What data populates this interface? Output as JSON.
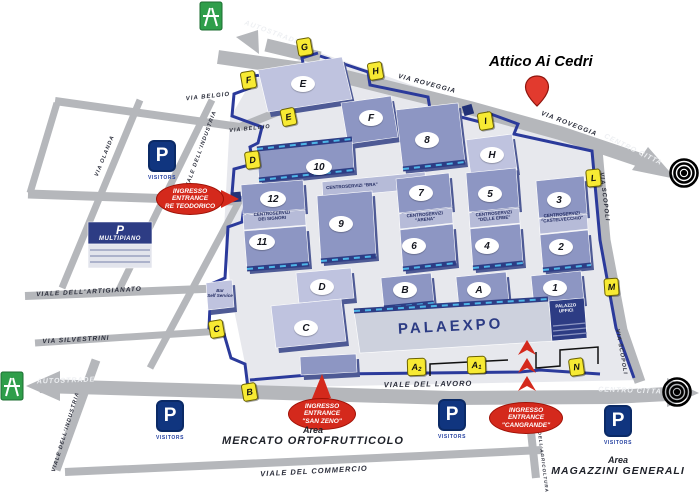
{
  "annotation": {
    "title": "Attico Ai Cedri"
  },
  "colors": {
    "road": "#b5b7bb",
    "boundary": "#2b3a9b",
    "hall": "#8d96c3",
    "hall_light": "#bfc3df",
    "service_strip": "#b6bbd8",
    "navy": "#2d3c84",
    "cyan_dash": "#4db5e8",
    "gate_yellow": "#f7ea33",
    "entrance_red": "#d4291c",
    "motorway_green": "#2f9e4a",
    "parking_navy": "#10357f",
    "ground": "#e7e8ed"
  },
  "roads": {
    "labels": [
      {
        "text": "AUTOSTRADE",
        "x": 272,
        "y": 33,
        "rot": 20,
        "tone": "light",
        "size": 7
      },
      {
        "text": "VIA  ROVEGGIA",
        "x": 427,
        "y": 84,
        "rot": 15,
        "tone": "dark",
        "size": 6.5
      },
      {
        "text": "VIA  ROVEGGIA",
        "x": 569,
        "y": 124,
        "rot": 21,
        "tone": "dark",
        "size": 6.5
      },
      {
        "text": "CENTRO CITTA",
        "x": 633,
        "y": 150,
        "rot": 26,
        "tone": "light",
        "size": 7
      },
      {
        "text": "VIA SCOPOLI",
        "x": 604,
        "y": 197,
        "rot": 83,
        "tone": "dark",
        "size": 6
      },
      {
        "text": "VIA SCOPOLI",
        "x": 621,
        "y": 352,
        "rot": 80,
        "tone": "dark",
        "size": 5.5
      },
      {
        "text": "VIA BELGIO",
        "x": 208,
        "y": 97,
        "rot": -6,
        "tone": "dark",
        "size": 6
      },
      {
        "text": "VIA BELGIO",
        "x": 250,
        "y": 129,
        "rot": -6,
        "tone": "dark",
        "size": 5.5
      },
      {
        "text": "VIA OLANDA",
        "x": 105,
        "y": 156,
        "rot": -68,
        "tone": "dark",
        "size": 5.5
      },
      {
        "text": "VIALE DELL'INDUSTRIA",
        "x": 201,
        "y": 150,
        "rot": -70,
        "tone": "dark",
        "size": 5.5
      },
      {
        "text": "VIALE DELL'ARTIGIANATO",
        "x": 89,
        "y": 292,
        "rot": -3,
        "tone": "dark",
        "size": 6.5
      },
      {
        "text": "VIA SILVESTRINI",
        "x": 76,
        "y": 340,
        "rot": -3,
        "tone": "dark",
        "size": 6.5
      },
      {
        "text": "AUTOSTRADE",
        "x": 66,
        "y": 381,
        "rot": -2,
        "tone": "light",
        "size": 7
      },
      {
        "text": "VIALE DELL'INDUSTRIA",
        "x": 66,
        "y": 432,
        "rot": -73,
        "tone": "dark",
        "size": 5.5
      },
      {
        "text": "VIALE  DEL  LAVORO",
        "x": 428,
        "y": 384,
        "rot": -1,
        "tone": "dark",
        "size": 7.5
      },
      {
        "text": "CENTRO CITTA",
        "x": 630,
        "y": 391,
        "rot": 2,
        "tone": "light",
        "size": 7
      },
      {
        "text": "VIALE DEL COMMERCIO",
        "x": 314,
        "y": 471,
        "rot": -3,
        "tone": "dark",
        "size": 7.5
      },
      {
        "text": "VIALE DELL'AGRICOLTURA",
        "x": 542,
        "y": 452,
        "rot": 83,
        "tone": "dark",
        "size": 4.5
      }
    ],
    "geometry": [
      {
        "id": "via-roveggia",
        "pts": "218,57 330,73 470,108 560,133 640,160",
        "w": 14
      },
      {
        "id": "autostrade-top",
        "pts": "320,58 266,45",
        "w": 13
      },
      {
        "id": "via-belgio",
        "pts": "55,101 240,127",
        "w": 8
      },
      {
        "id": "belgio-link",
        "pts": "240,127 310,99",
        "w": 8
      },
      {
        "id": "left-edge",
        "pts": "57,103 30,193",
        "w": 7
      },
      {
        "id": "via-olanda",
        "pts": "62,288 140,100",
        "w": 7
      },
      {
        "id": "viale-industria",
        "pts": "118,292 212,100",
        "w": 7
      },
      {
        "id": "diagonal-3",
        "pts": "150,368 242,196",
        "w": 7
      },
      {
        "id": "teodorico-road",
        "pts": "28,194 236,201",
        "w": 9
      },
      {
        "id": "viale-artigianato",
        "pts": "25,296 228,288",
        "w": 8
      },
      {
        "id": "via-silvestrini",
        "pts": "35,343 222,331",
        "w": 7
      },
      {
        "id": "lavoro-autostrade",
        "pts": "40,386 250,392 450,398 612,397 668,394",
        "w": 14
      },
      {
        "id": "via-scopoli",
        "pts": "597,150 605,240 622,330 640,382",
        "w": 11
      },
      {
        "id": "industria-lower",
        "pts": "96,360 56,470",
        "w": 9
      },
      {
        "id": "viale-commercio",
        "pts": "65,472 420,456 542,450",
        "w": 8
      },
      {
        "id": "viale-agricoltura",
        "pts": "536,478 528,404",
        "w": 8
      }
    ],
    "arrowheads": [
      {
        "id": "centro-citta-top-arrow",
        "pts": "648,147 676,179 632,170"
      },
      {
        "id": "autostrade-top-arrow",
        "pts": "258,30 236,37 259,54"
      },
      {
        "id": "autostrade-left-arrow",
        "pts": "60,371 26,386 60,401"
      },
      {
        "id": "centro-citta-right-arrow",
        "pts": "667,378 699,393 667,407"
      }
    ],
    "boundary": [
      "318,53 302,58 304,68 254,76 250,88 234,94 232,116 262,127 258,143 250,147 253,164 234,169 232,194 245,199 242,222 228,227 225,278 211,284 209,328 224,334 231,358 245,364 248,388",
      "320,56 368,72 370,85 428,97 430,109 484,123 488,113 518,124 514,134 592,151 600,240 616,328 634,378",
      "250,380 320,374 322,367 334,367 336,374 520,372 540,370 600,374"
    ],
    "ground": "318,52 420,88 500,114 594,150 606,240 622,330 640,380 250,388 232,300 224,230 230,118 252,80"
  },
  "gates": {
    "items": [
      {
        "id": "G",
        "x": 303,
        "y": 46,
        "rot": -10
      },
      {
        "id": "F",
        "x": 247,
        "y": 79,
        "rot": -10
      },
      {
        "id": "H",
        "x": 374,
        "y": 70,
        "rot": -10
      },
      {
        "id": "E",
        "x": 287,
        "y": 116,
        "rot": -12
      },
      {
        "id": "D",
        "x": 251,
        "y": 159,
        "rot": -8
      },
      {
        "id": "I",
        "x": 484,
        "y": 120,
        "rot": -10
      },
      {
        "id": "L",
        "x": 592,
        "y": 177,
        "rot": -6
      },
      {
        "id": "M",
        "x": 610,
        "y": 286,
        "rot": -4
      },
      {
        "id": "C",
        "x": 215,
        "y": 328,
        "rot": -10
      },
      {
        "id": "B",
        "x": 248,
        "y": 391,
        "rot": -10
      },
      {
        "id": "A2",
        "main": "A",
        "sub": "2",
        "x": 415,
        "y": 366,
        "rot": -2
      },
      {
        "id": "A1",
        "main": "A",
        "sub": "1",
        "x": 475,
        "y": 364,
        "rot": -2
      },
      {
        "id": "N",
        "x": 575,
        "y": 366,
        "rot": -8
      }
    ]
  },
  "halls": {
    "badges": [
      {
        "id": "E",
        "x": 303,
        "y": 84
      },
      {
        "id": "F",
        "x": 371,
        "y": 118
      },
      {
        "id": "8",
        "x": 427,
        "y": 140
      },
      {
        "id": "H",
        "x": 492,
        "y": 155
      },
      {
        "id": "10",
        "x": 319,
        "y": 167
      },
      {
        "id": "12",
        "x": 273,
        "y": 199
      },
      {
        "id": "9",
        "x": 341,
        "y": 224
      },
      {
        "id": "11",
        "x": 262,
        "y": 242
      },
      {
        "id": "7",
        "x": 421,
        "y": 193
      },
      {
        "id": "6",
        "x": 414,
        "y": 246
      },
      {
        "id": "5",
        "x": 490,
        "y": 194
      },
      {
        "id": "4",
        "x": 487,
        "y": 246
      },
      {
        "id": "3",
        "x": 559,
        "y": 200
      },
      {
        "id": "2",
        "x": 561,
        "y": 247
      },
      {
        "id": "1",
        "x": 555,
        "y": 288
      },
      {
        "id": "B",
        "x": 405,
        "y": 290
      },
      {
        "id": "A",
        "x": 479,
        "y": 290
      },
      {
        "id": "D",
        "x": 322,
        "y": 287
      },
      {
        "id": "C",
        "x": 306,
        "y": 328
      }
    ],
    "shapes": [
      {
        "id": "hall-E",
        "pts": "258,70 342,57 352,99 268,112",
        "fill": "pale",
        "band": "none"
      },
      {
        "id": "hall-F",
        "pts": "341,103 391,96 398,137 348,144",
        "fill": "slate",
        "band": "none"
      },
      {
        "id": "hall-8",
        "pts": "396,110 458,103 465,162 403,169",
        "fill": "slate",
        "band": "bottom"
      },
      {
        "id": "hall-H",
        "pts": "466,140 512,134 517,170 471,176",
        "fill": "pale",
        "band": "none"
      },
      {
        "id": "hall-10",
        "pts": "257,149 352,139 354,170 259,180",
        "fill": "slate",
        "band": "both"
      },
      {
        "id": "strip-bra",
        "pts": "322,182 425,172 426,188 323,198",
        "fill": "strip",
        "band": "none"
      },
      {
        "id": "hall-12",
        "pts": "241,185 303,180 305,209 243,214",
        "fill": "slate",
        "band": "none"
      },
      {
        "id": "strip-signori",
        "pts": "243,215 305,210 306,225 244,230",
        "fill": "strip",
        "band": "none"
      },
      {
        "id": "hall-11",
        "pts": "244,231 306,226 309,264 247,269",
        "fill": "slate",
        "band": "bottom"
      },
      {
        "id": "hall-9",
        "pts": "317,196 372,191 376,256 321,261",
        "fill": "slate",
        "band": "bottom"
      },
      {
        "id": "hall-7",
        "pts": "396,179 449,173 452,207 399,213",
        "fill": "slate",
        "band": "none"
      },
      {
        "id": "strip-arena",
        "pts": "399,214 452,208 453,223 400,229",
        "fill": "strip",
        "band": "none"
      },
      {
        "id": "hall-6",
        "pts": "400,230 453,224 456,263 403,269",
        "fill": "slate",
        "band": "bottom"
      },
      {
        "id": "hall-5",
        "pts": "466,173 516,168 519,207 469,212",
        "fill": "slate",
        "band": "none"
      },
      {
        "id": "strip-erbe",
        "pts": "469,213 519,208 520,223 470,228",
        "fill": "strip",
        "band": "none"
      },
      {
        "id": "hall-4",
        "pts": "470,229 520,224 523,263 473,268",
        "fill": "slate",
        "band": "bottom"
      },
      {
        "id": "hall-3",
        "pts": "536,181 584,176 587,213 539,218",
        "fill": "slate",
        "band": "none"
      },
      {
        "id": "strip-castelvecchio",
        "pts": "539,219 587,214 588,229 540,234",
        "fill": "strip",
        "band": "none"
      },
      {
        "id": "hall-2",
        "pts": "540,235 588,230 591,265 543,270",
        "fill": "slate",
        "band": "bottom"
      },
      {
        "id": "hall-1",
        "pts": "531,276 581,271 584,301 534,306",
        "fill": "slate",
        "band": "bottom"
      },
      {
        "id": "hall-B",
        "pts": "381,278 431,273 434,303 384,308",
        "fill": "slate",
        "band": "bottom"
      },
      {
        "id": "hall-A",
        "pts": "456,277 506,272 509,302 459,307",
        "fill": "slate",
        "band": "bottom"
      },
      {
        "id": "hall-D",
        "pts": "296,273 351,268 354,298 299,303",
        "fill": "pale",
        "band": "none"
      },
      {
        "id": "hall-C",
        "pts": "271,306 341,299 346,341 276,348",
        "fill": "pale",
        "band": "none"
      },
      {
        "id": "palaexpo-bldg",
        "pts": "354,311 548,299 554,341 360,353",
        "fill": "palefill",
        "band": "top"
      },
      {
        "id": "palazzo-uffici-bldg",
        "pts": "549,301 584,298 587,338 552,341",
        "fill": "navy",
        "band": "none"
      },
      {
        "id": "bar-bldg",
        "pts": "206,283 232,280 234,307 208,310",
        "fill": "pale",
        "band": "none"
      },
      {
        "id": "south-wall",
        "pts": "300,357 356,354 357,372 301,375",
        "fill": "slate",
        "band": "none"
      },
      {
        "id": "multipiano-top",
        "pts": "88,222 152,222 152,244 88,244",
        "fill": "navy",
        "band": "none"
      },
      {
        "id": "multipiano-front",
        "pts": "88,244 152,244 152,268 88,268",
        "fill": "palefront",
        "band": "none"
      }
    ]
  },
  "service_centers": {
    "labels": [
      {
        "id": "bra",
        "lines": [
          "CENTROSERVIZI \"BRA\""
        ],
        "x": 352,
        "y": 186,
        "rot": -4
      },
      {
        "id": "dei-signori",
        "lines": [
          "CENTROSERVIZI",
          "DEI SIGNORI"
        ],
        "x": 272,
        "y": 216,
        "rot": -4
      },
      {
        "id": "arena",
        "lines": [
          "CENTROSERVIZI",
          "\"ARENA\""
        ],
        "x": 425,
        "y": 217,
        "rot": -5
      },
      {
        "id": "delle-erbe",
        "lines": [
          "CENTROSERVIZI",
          "\"DELLE ERBE\""
        ],
        "x": 494,
        "y": 216,
        "rot": -5
      },
      {
        "id": "castelvecchio",
        "lines": [
          "CENTROSERVIZI",
          "\"CASTELVECCHIO\""
        ],
        "x": 562,
        "y": 217,
        "rot": -5
      }
    ]
  },
  "buildings": {
    "palaexpo": "PALAEXPO",
    "palazzo_uffici": [
      "PALAZZO",
      "UFFICI"
    ],
    "bar": [
      "Bar",
      "Self Service"
    ],
    "multipiano": {
      "p": "P",
      "label": "MULTIPIANO"
    }
  },
  "parking": {
    "p": "P",
    "caption": "VISITORS",
    "items": [
      {
        "x": 161,
        "y": 158
      },
      {
        "x": 169,
        "y": 418
      },
      {
        "x": 451,
        "y": 417
      },
      {
        "x": 617,
        "y": 423
      }
    ]
  },
  "entrances": {
    "items": [
      {
        "id": "re-teodorico",
        "lines": [
          "INGRESSO",
          "ENTRANCE",
          "RE TEODORICO"
        ],
        "x": 189,
        "y": 198,
        "w": 66,
        "h": 30
      },
      {
        "id": "san-zeno",
        "lines": [
          "INGRESSO",
          "ENTRANCE",
          "\"SAN ZENO\""
        ],
        "x": 321,
        "y": 413,
        "w": 66,
        "h": 30
      },
      {
        "id": "cangrande",
        "lines": [
          "INGRESSO",
          "ENTRANCE",
          "\"CANGRANDE\""
        ],
        "x": 525,
        "y": 417,
        "w": 72,
        "h": 30
      }
    ]
  },
  "areas": {
    "items": [
      {
        "id": "mercato",
        "line1": "Area",
        "line2": "MERCATO ORTOFRUTTICOLO",
        "x": 313,
        "y": 436,
        "size": 11
      },
      {
        "id": "magazzini",
        "line1": "Area",
        "line2": "MAGAZZINI GENERALI",
        "x": 618,
        "y": 466,
        "size": 10.5
      }
    ]
  }
}
